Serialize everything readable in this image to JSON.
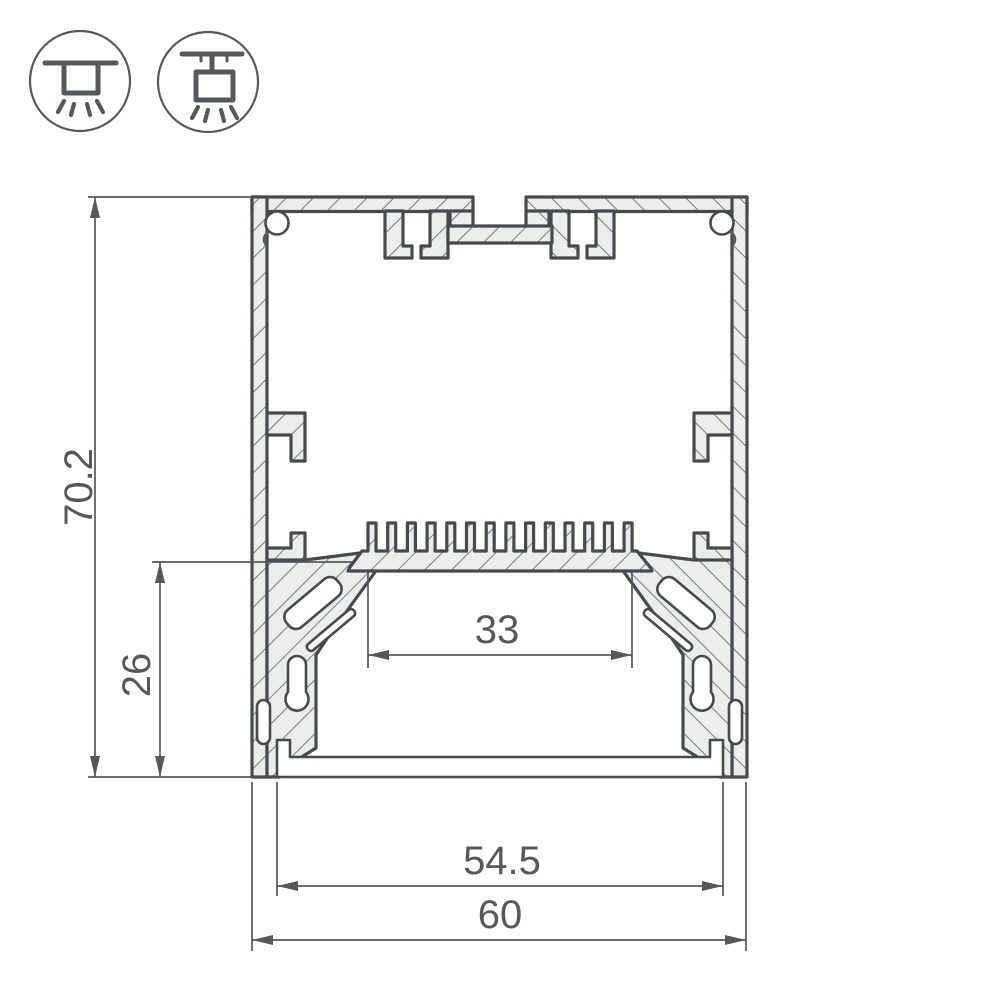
{
  "drawing": {
    "dimensions": [
      {
        "name": "overall-height",
        "value": "70.2"
      },
      {
        "name": "lower-chamber-height",
        "value": "26"
      },
      {
        "name": "led-platform-width",
        "value": "33"
      },
      {
        "name": "inner-width",
        "value": "54.5"
      },
      {
        "name": "overall-width",
        "value": "60"
      }
    ],
    "icons": [
      {
        "name": "surface-mount-light-icon"
      },
      {
        "name": "pendant-light-icon"
      }
    ],
    "colors": {
      "outline": "#474b4d",
      "aluminum_fill": "#ebeced",
      "dimension_lines": "#55595b",
      "background": "#ffffff"
    }
  }
}
